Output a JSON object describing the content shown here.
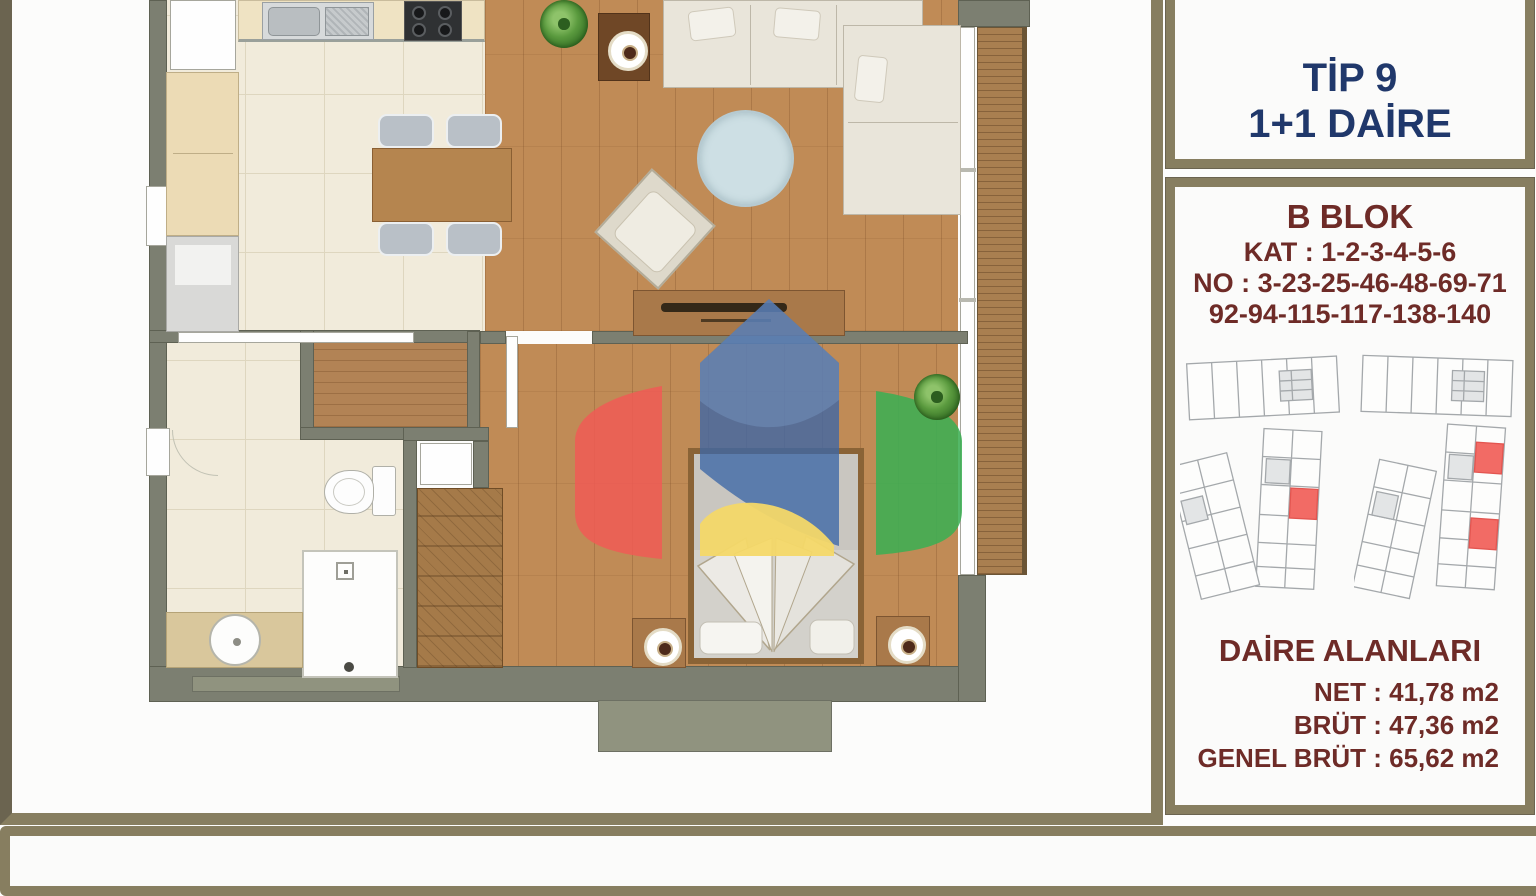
{
  "header_box": {
    "type_label": "TİP 9",
    "unit_label": "1+1 DAİRE"
  },
  "info_box": {
    "block_title": "B BLOK",
    "floors_line": "KAT : 1-2-3-4-5-6",
    "numbers_line_1": "NO : 3-23-25-46-48-69-71",
    "numbers_line_2": "92-94-115-117-138-140",
    "areas": {
      "title": "DAİRE ALANLARI",
      "net": "NET : 41,78 m2",
      "brut": "BRÜT : 47,36 m2",
      "genel_brut": "GENEL BRÜT : 65,62 m2"
    }
  },
  "palette": {
    "panel_border": "#877e60",
    "title_navy": "#20386b",
    "info_maroon": "#6e2b27",
    "wall_gray": "#7c7f71",
    "wood_floor": "#c08b56",
    "tile_floor": "#f1ebdb",
    "balcony_wood": "#a97f50",
    "highlight_red": "#f26b65",
    "logo_blue": "#3c67a6",
    "logo_red": "#f05a55",
    "logo_green": "#3cae53",
    "logo_yellow": "#f4d868"
  }
}
